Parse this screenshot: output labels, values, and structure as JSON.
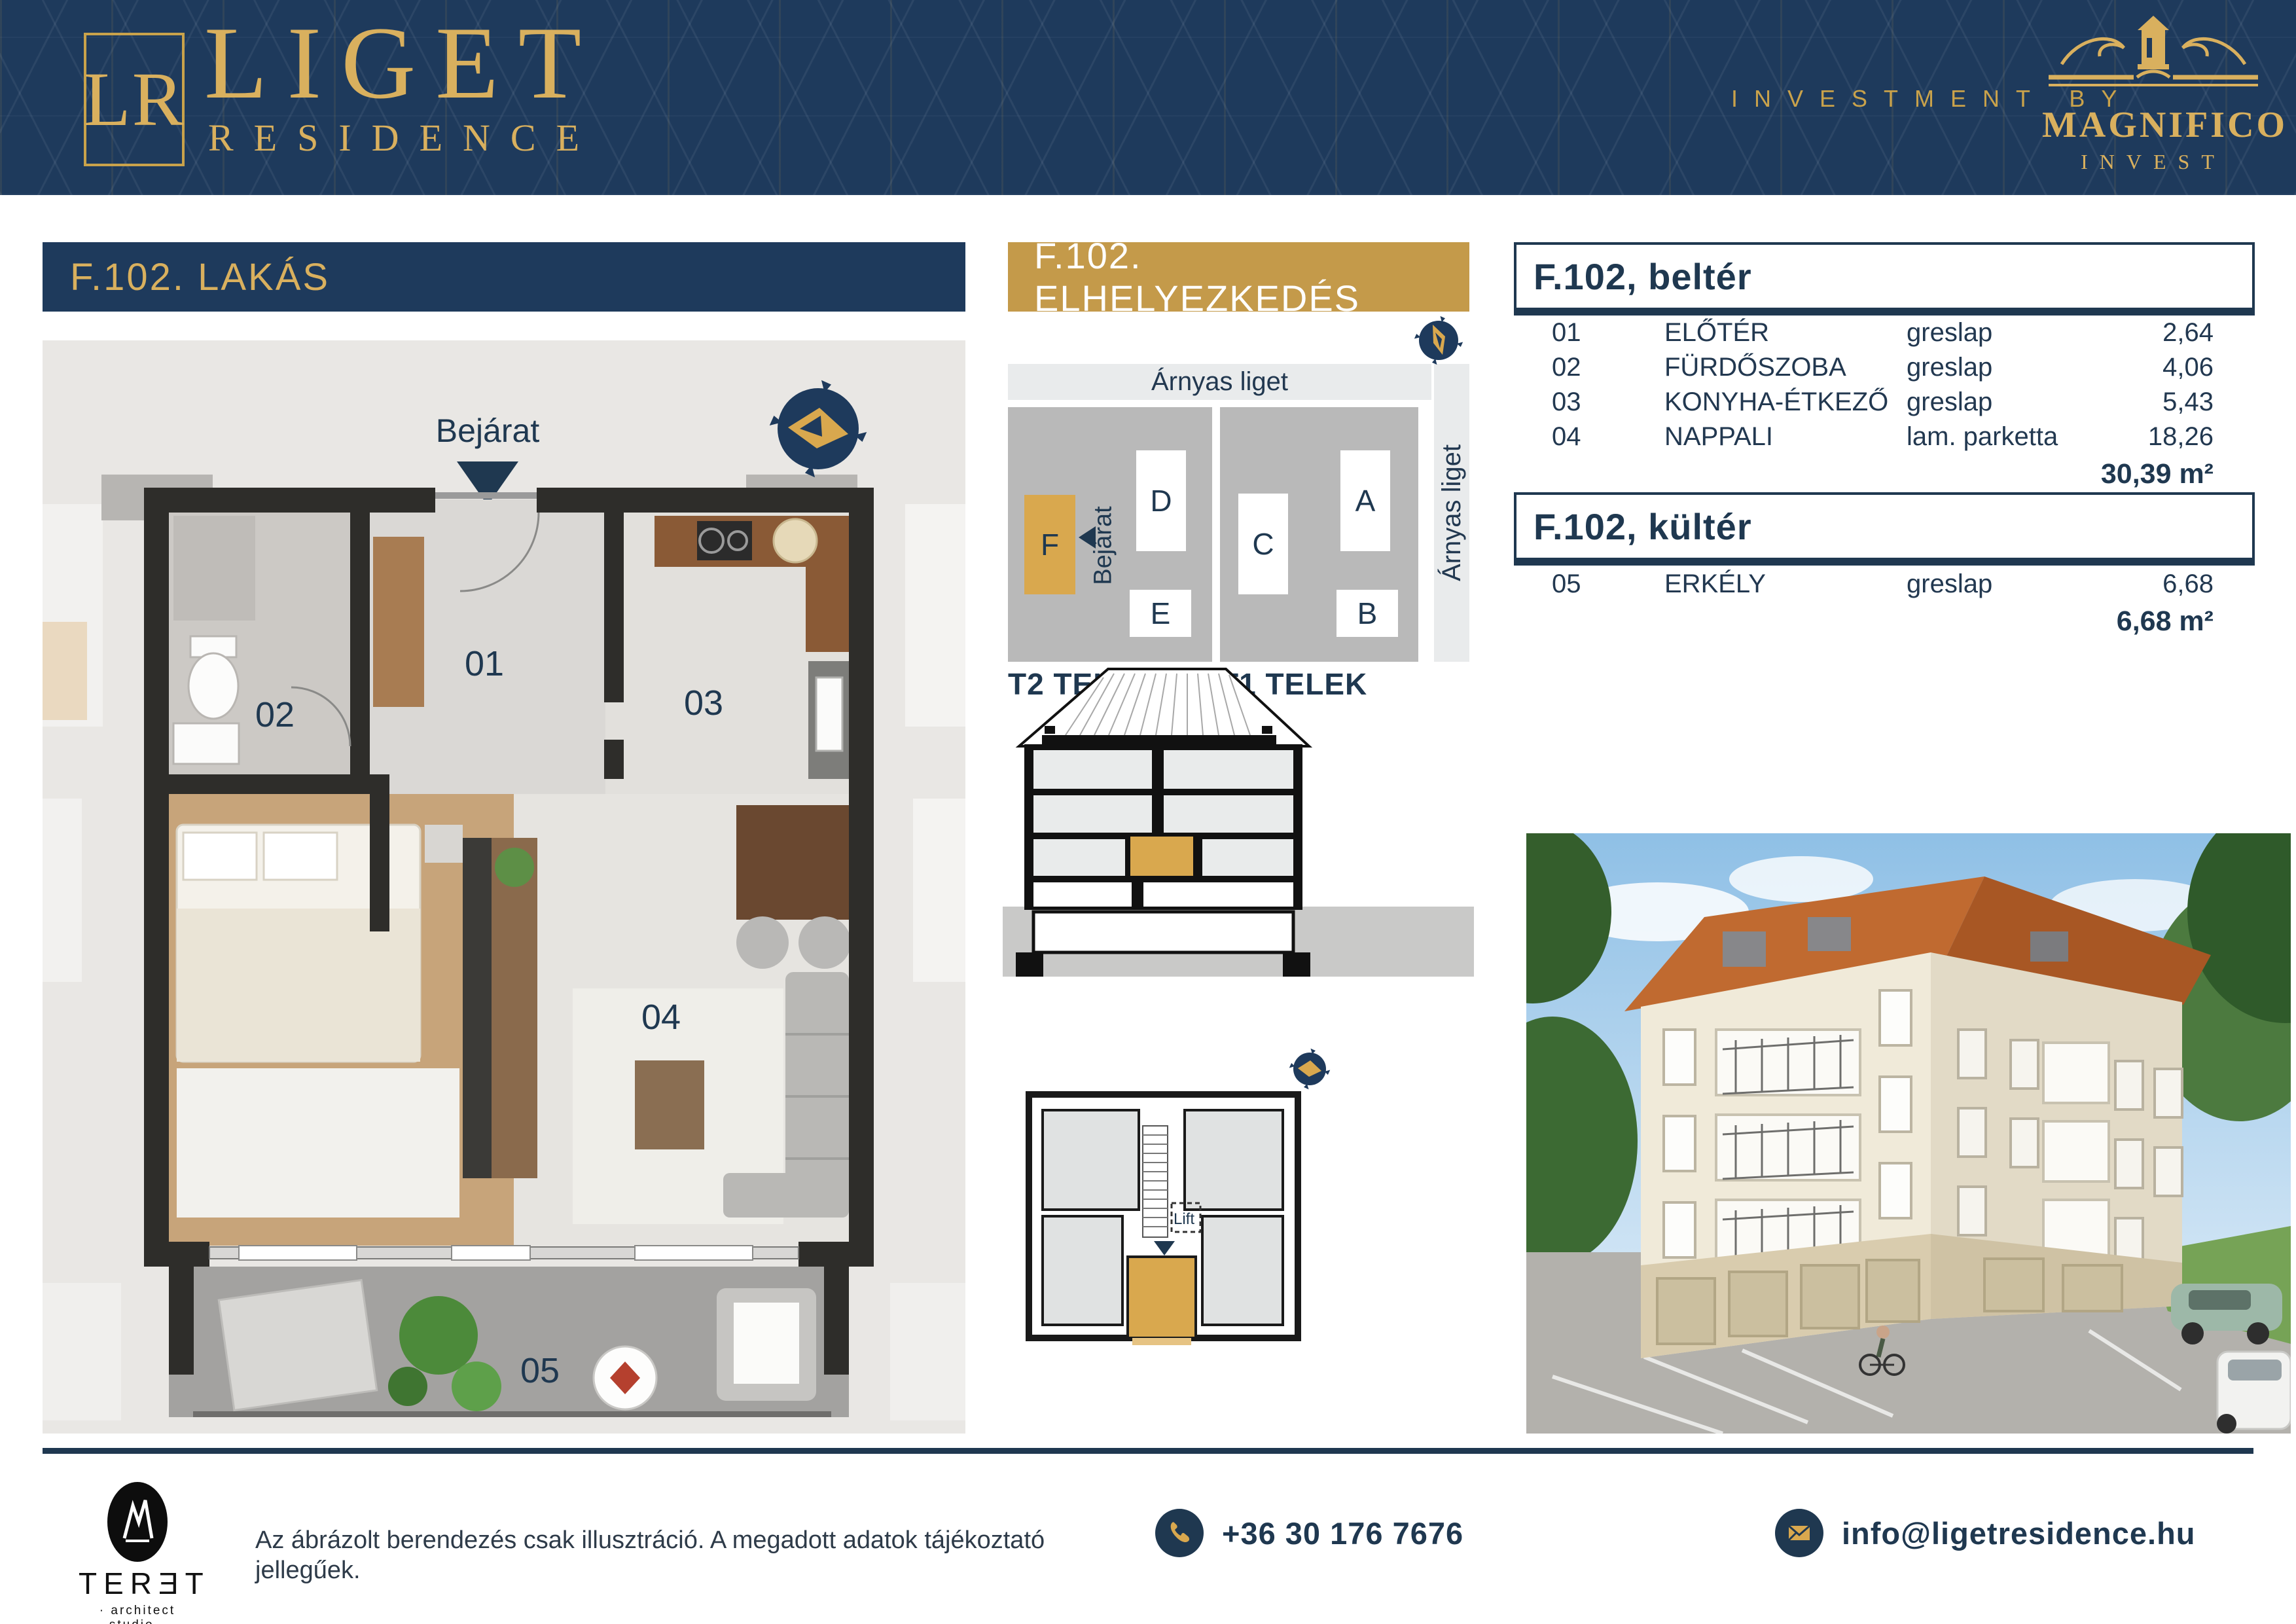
{
  "header": {
    "monogram": "LR",
    "brand": "LIGET",
    "brand_sub": "RESIDENCE",
    "investment_by": "INVESTMENT BY",
    "investor": "MAGNIFICO",
    "investor_sub": "INVEST"
  },
  "left_panel": {
    "title": "F.102. LAKÁS",
    "entrance": "Bejárat",
    "rooms": {
      "r01": "01",
      "r02": "02",
      "r03": "03",
      "r04": "04",
      "r05": "05"
    }
  },
  "site_panel": {
    "title": "F.102. ELHELYEZKEDÉS",
    "park_top": "Árnyas liget",
    "park_right": "Árnyas liget",
    "lot2": "T2 TELEK",
    "lot1": "T1 TELEK",
    "entrance": "Bejárat",
    "bldg_a": "A",
    "bldg_b": "B",
    "bldg_c": "C",
    "bldg_d": "D",
    "bldg_e": "E",
    "bldg_f": "F"
  },
  "key_plan": {
    "lift": "Lift"
  },
  "tables": {
    "interior": {
      "title": "F.102, beltér",
      "rows": [
        {
          "no": "01",
          "name": "ELŐTÉR",
          "finish": "greslap",
          "area": "2,64"
        },
        {
          "no": "02",
          "name": "FÜRDŐSZOBA",
          "finish": "greslap",
          "area": "4,06"
        },
        {
          "no": "03",
          "name": "KONYHA-ÉTKEZŐ",
          "finish": "greslap",
          "area": "5,43"
        },
        {
          "no": "04",
          "name": "NAPPALI",
          "finish": "lam. parketta",
          "area": "18,26"
        }
      ],
      "total": "30,39 m²"
    },
    "exterior": {
      "title": "F.102, kültér",
      "rows": [
        {
          "no": "05",
          "name": "ERKÉLY",
          "finish": "greslap",
          "area": "6,68"
        }
      ],
      "total": "6,68 m²"
    }
  },
  "footer": {
    "studio": "TERƎT",
    "studio_sub": "· architect  studio ·",
    "disclaimer": "Az ábrázolt berendezés csak illusztráció. A megadott adatok tájékoztató jellegűek.",
    "phone": "+36 30 176 7676",
    "email": "info@ligetresidence.hu"
  },
  "colors": {
    "navy": "#1E3A5C",
    "gold": "#C9A24B",
    "gold_bright": "#D9A84E",
    "text_navy": "#1F3850"
  }
}
